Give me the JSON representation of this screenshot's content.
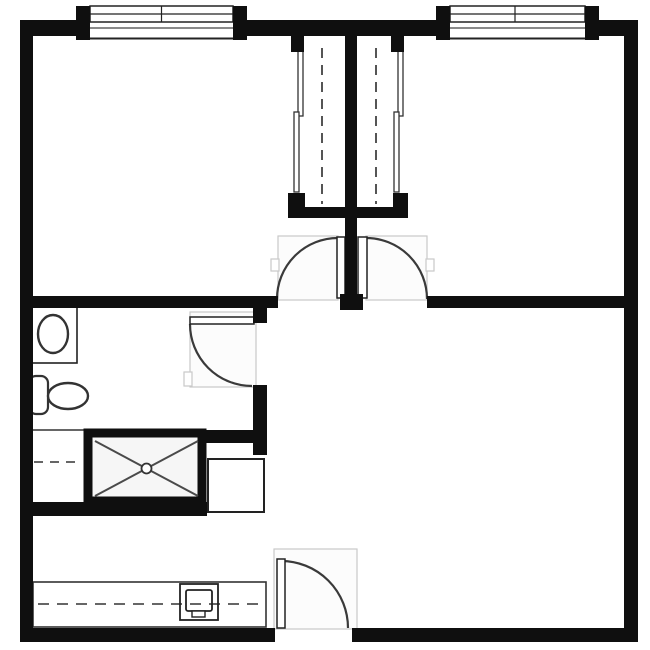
{
  "drawing": {
    "kind": "apartment-floor-plan",
    "canvas": {
      "width": 650,
      "height": 650,
      "background": "#ffffff"
    },
    "colors": {
      "wall": "#0f0f0f",
      "fixture_stroke": "#2e2e2e",
      "arc_stroke": "#3a3a3a",
      "dash_stroke": "#666666",
      "clearance_stroke": "#c9c9c9",
      "clearance_fill": "#fcfcfc",
      "shower_fill": "#f6f6f6"
    },
    "rooms": [
      {
        "name": "bedroom-left",
        "approx_bounds": [
          33,
          38,
          288,
          296
        ]
      },
      {
        "name": "bedroom-right",
        "approx_bounds": [
          408,
          38,
          624,
          296
        ]
      },
      {
        "name": "bathroom",
        "approx_bounds": [
          33,
          308,
          253,
          502
        ]
      },
      {
        "name": "living-area",
        "approx_bounds": [
          267,
          308,
          624,
          628
        ]
      },
      {
        "name": "kitchenette-desk-area",
        "approx_bounds": [
          33,
          516,
          274,
          628
        ]
      }
    ],
    "shapes": [
      {
        "type": "rect",
        "name": "background",
        "x": 0,
        "y": 0,
        "w": 650,
        "h": 650,
        "fill": "#ffffff"
      },
      {
        "type": "rect",
        "name": "door-clearance-bedroom-left",
        "x": 278,
        "y": 236,
        "w": 60,
        "h": 64,
        "fill": "#fcfcfc",
        "stroke": "#c9c9c9",
        "sw": 1.2
      },
      {
        "type": "rect",
        "name": "door-clearance-bedroom-right",
        "x": 366,
        "y": 236,
        "w": 61,
        "h": 64,
        "fill": "#fcfcfc",
        "stroke": "#c9c9c9",
        "sw": 1.2
      },
      {
        "type": "rect",
        "name": "door-clearance-bathroom",
        "x": 190,
        "y": 312,
        "w": 66,
        "h": 75,
        "fill": "#fcfcfc",
        "stroke": "#c9c9c9",
        "sw": 1.2
      },
      {
        "type": "rect",
        "name": "door-clearance-entry",
        "x": 274,
        "y": 549,
        "w": 83,
        "h": 80,
        "fill": "#fcfcfc",
        "stroke": "#c9c9c9",
        "sw": 1.2
      },
      {
        "type": "rect",
        "name": "door-jamb-notch-bedroom-left",
        "x": 271,
        "y": 259,
        "w": 8,
        "h": 12,
        "fill": "#ffffff",
        "stroke": "#c9c9c9",
        "sw": 1.2
      },
      {
        "type": "rect",
        "name": "door-jamb-notch-bedroom-right",
        "x": 426,
        "y": 259,
        "w": 8,
        "h": 12,
        "fill": "#ffffff",
        "stroke": "#c9c9c9",
        "sw": 1.2
      },
      {
        "type": "rect",
        "name": "door-jamb-notch-bathroom",
        "x": 184,
        "y": 372,
        "w": 8,
        "h": 14,
        "fill": "#ffffff",
        "stroke": "#c9c9c9",
        "sw": 1.2
      },
      {
        "type": "rect",
        "name": "window-left-glazing",
        "x": 90,
        "y": 6,
        "w": 143,
        "h": 16,
        "fill": "#ffffff",
        "stroke": "#222222",
        "sw": 1.5
      },
      {
        "type": "line",
        "name": "window-left-glazing-midline",
        "x1": 90,
        "y1": 14,
        "x2": 233,
        "y2": 14,
        "stroke": "#222222",
        "sw": 1.2
      },
      {
        "type": "line",
        "name": "window-left-mullion",
        "x1": 161.5,
        "y1": 6,
        "x2": 161.5,
        "y2": 22,
        "stroke": "#222222",
        "sw": 1.2
      },
      {
        "type": "line",
        "name": "window-left-sill-outer",
        "x1": 90,
        "y1": 28,
        "x2": 233,
        "y2": 28,
        "stroke": "#444444",
        "sw": 1.2
      },
      {
        "type": "line",
        "name": "window-left-sill-inner",
        "x1": 90,
        "y1": 38.5,
        "x2": 233,
        "y2": 38.5,
        "stroke": "#222222",
        "sw": 2
      },
      {
        "type": "rect",
        "name": "window-right-glazing",
        "x": 450,
        "y": 6,
        "w": 135,
        "h": 16,
        "fill": "#ffffff",
        "stroke": "#222222",
        "sw": 1.5
      },
      {
        "type": "line",
        "name": "window-right-glazing-midline",
        "x1": 450,
        "y1": 14,
        "x2": 585,
        "y2": 14,
        "stroke": "#222222",
        "sw": 1.2
      },
      {
        "type": "line",
        "name": "window-right-mullion",
        "x1": 515,
        "y1": 6,
        "x2": 515,
        "y2": 22,
        "stroke": "#222222",
        "sw": 1.2
      },
      {
        "type": "line",
        "name": "window-right-sill-outer",
        "x1": 450,
        "y1": 28,
        "x2": 585,
        "y2": 28,
        "stroke": "#444444",
        "sw": 1.2
      },
      {
        "type": "line",
        "name": "window-right-sill-inner",
        "x1": 450,
        "y1": 38.5,
        "x2": 585,
        "y2": 38.5,
        "stroke": "#222222",
        "sw": 2
      },
      {
        "type": "line",
        "name": "closet-rod-left",
        "x1": 322,
        "y1": 48,
        "x2": 322,
        "y2": 204,
        "stroke": "#555555",
        "sw": 2,
        "dash": "10,7"
      },
      {
        "type": "line",
        "name": "closet-rod-right",
        "x1": 376,
        "y1": 48,
        "x2": 376,
        "y2": 204,
        "stroke": "#555555",
        "sw": 2,
        "dash": "10,7"
      },
      {
        "type": "rect",
        "name": "closet-left-slider-panel-upper",
        "x": 298,
        "y": 48,
        "w": 5,
        "h": 68,
        "fill": "#ffffff",
        "stroke": "#333333",
        "sw": 1.3
      },
      {
        "type": "rect",
        "name": "closet-left-slider-panel-lower",
        "x": 294,
        "y": 112,
        "w": 5,
        "h": 80,
        "fill": "#ffffff",
        "stroke": "#333333",
        "sw": 1.3
      },
      {
        "type": "rect",
        "name": "closet-right-slider-panel-upper",
        "x": 398,
        "y": 48,
        "w": 5,
        "h": 68,
        "fill": "#ffffff",
        "stroke": "#333333",
        "sw": 1.3
      },
      {
        "type": "rect",
        "name": "closet-right-slider-panel-lower",
        "x": 394,
        "y": 112,
        "w": 5,
        "h": 80,
        "fill": "#ffffff",
        "stroke": "#333333",
        "sw": 1.3
      },
      {
        "type": "rect",
        "name": "toilet-tank",
        "x": 29,
        "y": 376,
        "w": 19,
        "h": 38,
        "rx": 7,
        "fill": "#ffffff",
        "stroke": "#333333",
        "sw": 2.2
      },
      {
        "type": "ellipse",
        "name": "toilet-bowl",
        "cx": 68,
        "cy": 396,
        "rxr": 20,
        "ryr": 13,
        "fill": "#ffffff",
        "stroke": "#333333",
        "sw": 2.4
      },
      {
        "type": "rect",
        "name": "sink-counter",
        "x": 32,
        "y": 306,
        "w": 45,
        "h": 57,
        "fill": "#ffffff",
        "stroke": "#222222",
        "sw": 1.6
      },
      {
        "type": "ellipse",
        "name": "sink-basin",
        "cx": 53,
        "cy": 334,
        "rxr": 15,
        "ryr": 19,
        "fill": "#ffffff",
        "stroke": "#333333",
        "sw": 2.4
      },
      {
        "type": "line",
        "name": "linen-nook-edge",
        "x1": 33,
        "y1": 430,
        "x2": 84,
        "y2": 430,
        "stroke": "#333333",
        "sw": 1.6
      },
      {
        "type": "line",
        "name": "linen-nook-shelf-dashed",
        "x1": 34,
        "y1": 462,
        "x2": 79,
        "y2": 462,
        "stroke": "#666666",
        "sw": 2,
        "dash": "9,7"
      },
      {
        "type": "rect",
        "name": "shower-pan",
        "x": 88,
        "y": 433,
        "w": 114,
        "h": 68,
        "fill": "#f6f6f6",
        "stroke": "#0f0f0f",
        "sw": 9
      },
      {
        "type": "line",
        "name": "shower-diagonal-1",
        "x1": 95,
        "y1": 441,
        "x2": 198,
        "y2": 496,
        "stroke": "#4a4a4a",
        "sw": 2
      },
      {
        "type": "line",
        "name": "shower-diagonal-2",
        "x1": 95,
        "y1": 496,
        "x2": 198,
        "y2": 441,
        "stroke": "#4a4a4a",
        "sw": 2
      },
      {
        "type": "circle",
        "name": "shower-drain",
        "cx": 146.5,
        "cy": 468.5,
        "r": 5,
        "fill": "#ffffff",
        "stroke": "#333333",
        "sw": 1.8
      },
      {
        "type": "rect",
        "name": "utility-cabinet",
        "x": 208,
        "y": 459,
        "w": 56,
        "h": 53,
        "fill": "#ffffff",
        "stroke": "#222222",
        "sw": 2
      },
      {
        "type": "rect",
        "name": "kitchen-counter",
        "x": 33,
        "y": 582,
        "w": 233,
        "h": 45,
        "fill": "#ffffff",
        "stroke": "#333333",
        "sw": 1.6
      },
      {
        "type": "line",
        "name": "kitchen-counter-overhang-dashed",
        "x1": 38,
        "y1": 604,
        "x2": 258,
        "y2": 604,
        "stroke": "#666666",
        "sw": 2,
        "dash": "11,8"
      },
      {
        "type": "rect",
        "name": "computer-outline",
        "x": 180,
        "y": 584,
        "w": 38,
        "h": 36,
        "fill": "none",
        "stroke": "#222222",
        "sw": 1.8
      },
      {
        "type": "rect",
        "name": "computer-screen",
        "x": 186,
        "y": 590,
        "w": 26,
        "h": 21,
        "rx": 2,
        "fill": "none",
        "stroke": "#222222",
        "sw": 1.8
      },
      {
        "type": "rect",
        "name": "computer-base",
        "x": 192,
        "y": 611,
        "w": 13,
        "h": 6,
        "fill": "#ffffff",
        "stroke": "#222222",
        "sw": 1.4
      },
      {
        "type": "path",
        "name": "door-swing-bedroom-left",
        "d": "M 277 299 A 61 61 0 0 1 338 238",
        "fill": "none",
        "stroke": "#3a3a3a",
        "sw": 2.2
      },
      {
        "type": "rect",
        "name": "door-leaf-bedroom-left",
        "x": 337,
        "y": 237,
        "w": 8,
        "h": 61,
        "fill": "#ffffff",
        "stroke": "#222222",
        "sw": 1.5
      },
      {
        "type": "path",
        "name": "door-swing-bedroom-right",
        "d": "M 366 238 A 61 61 0 0 1 427 299",
        "fill": "none",
        "stroke": "#3a3a3a",
        "sw": 2.2
      },
      {
        "type": "rect",
        "name": "door-leaf-bedroom-right",
        "x": 358,
        "y": 237,
        "w": 9,
        "h": 61,
        "fill": "#ffffff",
        "stroke": "#222222",
        "sw": 1.5
      },
      {
        "type": "path",
        "name": "door-swing-bathroom",
        "d": "M 190 324 A 62 62 0 0 0 252 386",
        "fill": "none",
        "stroke": "#3a3a3a",
        "sw": 2.2
      },
      {
        "type": "rect",
        "name": "door-leaf-bathroom",
        "x": 190,
        "y": 317,
        "w": 64,
        "h": 7,
        "fill": "#ffffff",
        "stroke": "#222222",
        "sw": 1.5
      },
      {
        "type": "path",
        "name": "door-swing-entry",
        "d": "M 281 561 A 67 67 0 0 1 348 628",
        "fill": "none",
        "stroke": "#3a3a3a",
        "sw": 2.2
      },
      {
        "type": "rect",
        "name": "door-leaf-entry",
        "x": 277,
        "y": 559,
        "w": 8,
        "h": 69,
        "fill": "#ffffff",
        "stroke": "#222222",
        "sw": 1.5
      },
      {
        "type": "rect",
        "name": "wall-top-left-segment",
        "x": 20,
        "y": 20,
        "w": 57,
        "h": 16,
        "fill": "#0f0f0f"
      },
      {
        "type": "rect",
        "name": "wall-top-middle-segment",
        "x": 247,
        "y": 20,
        "w": 191,
        "h": 16,
        "fill": "#0f0f0f"
      },
      {
        "type": "rect",
        "name": "wall-top-right-segment",
        "x": 599,
        "y": 20,
        "w": 39,
        "h": 16,
        "fill": "#0f0f0f"
      },
      {
        "type": "rect",
        "name": "window-left-jamb-a",
        "x": 76,
        "y": 6,
        "w": 14,
        "h": 34,
        "fill": "#0f0f0f"
      },
      {
        "type": "rect",
        "name": "window-left-jamb-b",
        "x": 233,
        "y": 6,
        "w": 14,
        "h": 34,
        "fill": "#0f0f0f"
      },
      {
        "type": "rect",
        "name": "window-right-jamb-a",
        "x": 436,
        "y": 6,
        "w": 14,
        "h": 34,
        "fill": "#0f0f0f"
      },
      {
        "type": "rect",
        "name": "window-right-jamb-b",
        "x": 585,
        "y": 6,
        "w": 14,
        "h": 34,
        "fill": "#0f0f0f"
      },
      {
        "type": "rect",
        "name": "wall-left-exterior",
        "x": 20,
        "y": 20,
        "w": 13,
        "h": 622,
        "fill": "#0f0f0f"
      },
      {
        "type": "rect",
        "name": "wall-right-exterior",
        "x": 624,
        "y": 20,
        "w": 14,
        "h": 622,
        "fill": "#0f0f0f"
      },
      {
        "type": "rect",
        "name": "wall-bottom-left-segment",
        "x": 20,
        "y": 628,
        "w": 255,
        "h": 14,
        "fill": "#0f0f0f"
      },
      {
        "type": "rect",
        "name": "wall-bottom-right-segment",
        "x": 352,
        "y": 628,
        "w": 286,
        "h": 14,
        "fill": "#0f0f0f"
      },
      {
        "type": "rect",
        "name": "wall-divider-left",
        "x": 20,
        "y": 296,
        "w": 258,
        "h": 12,
        "fill": "#0f0f0f"
      },
      {
        "type": "rect",
        "name": "wall-divider-right",
        "x": 427,
        "y": 296,
        "w": 211,
        "h": 12,
        "fill": "#0f0f0f"
      },
      {
        "type": "rect",
        "name": "wall-divider-center-post",
        "x": 340,
        "y": 294,
        "w": 23,
        "h": 16,
        "fill": "#0f0f0f"
      },
      {
        "type": "rect",
        "name": "wall-closet-center",
        "x": 345,
        "y": 36,
        "w": 12,
        "h": 260,
        "fill": "#0f0f0f"
      },
      {
        "type": "rect",
        "name": "wall-closet-front",
        "x": 288,
        "y": 207,
        "w": 120,
        "h": 11,
        "fill": "#0f0f0f"
      },
      {
        "type": "rect",
        "name": "closet-jamb-top-left",
        "x": 291,
        "y": 36,
        "w": 13,
        "h": 16,
        "fill": "#0f0f0f"
      },
      {
        "type": "rect",
        "name": "closet-jamb-top-right",
        "x": 391,
        "y": 36,
        "w": 13,
        "h": 16,
        "fill": "#0f0f0f"
      },
      {
        "type": "rect",
        "name": "closet-jamb-bottom-left",
        "x": 288,
        "y": 193,
        "w": 17,
        "h": 25,
        "fill": "#0f0f0f"
      },
      {
        "type": "rect",
        "name": "closet-jamb-bottom-right",
        "x": 393,
        "y": 193,
        "w": 15,
        "h": 25,
        "fill": "#0f0f0f"
      },
      {
        "type": "rect",
        "name": "wall-bathroom-door-stub",
        "x": 253,
        "y": 308,
        "w": 14,
        "h": 15,
        "fill": "#0f0f0f"
      },
      {
        "type": "rect",
        "name": "wall-bathroom-right",
        "x": 253,
        "y": 385,
        "w": 14,
        "h": 70,
        "fill": "#0f0f0f"
      },
      {
        "type": "rect",
        "name": "wall-bathroom-nook-stub",
        "x": 200,
        "y": 430,
        "w": 67,
        "h": 13,
        "fill": "#0f0f0f"
      },
      {
        "type": "rect",
        "name": "wall-bath-kitchen-divider",
        "x": 30,
        "y": 502,
        "w": 177,
        "h": 14,
        "fill": "#0f0f0f"
      }
    ]
  }
}
